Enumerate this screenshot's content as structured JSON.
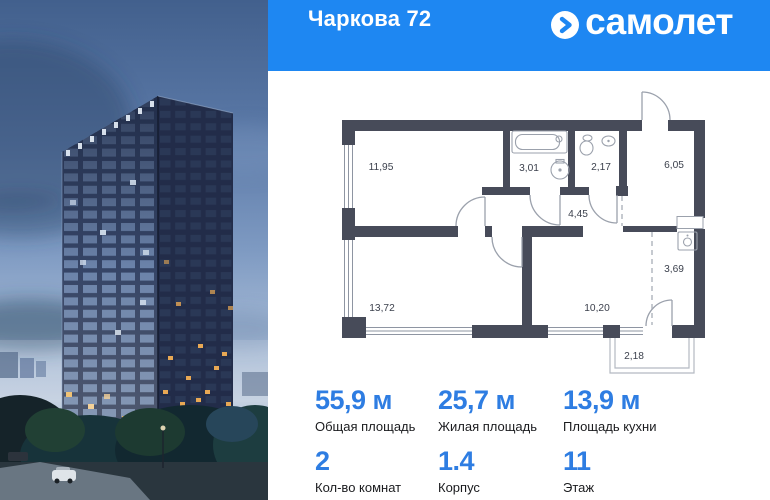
{
  "header": {
    "title": "Чаркова 72",
    "brand": {
      "icon": "samolet-arrow-circle-icon",
      "name": "самолет"
    }
  },
  "floor_plan": {
    "rooms": [
      {
        "name": "bedroom-1",
        "area": "11,95"
      },
      {
        "name": "bathroom",
        "area": "3,01"
      },
      {
        "name": "toilet",
        "area": "2,17"
      },
      {
        "name": "entrance-hall",
        "area": "6,05"
      },
      {
        "name": "corridor",
        "area": "4,45"
      },
      {
        "name": "bedroom-2",
        "area": "13,72"
      },
      {
        "name": "kitchen-living",
        "area": "10,20"
      },
      {
        "name": "kitchen-niche",
        "area": "3,69"
      },
      {
        "name": "balcony",
        "area": "2,18"
      }
    ],
    "fixtures": [
      "bathtub-icon",
      "washbasin-icon",
      "toilet-icon",
      "sink-icon",
      "kitchen-sink-icon"
    ]
  },
  "stats": {
    "primary": [
      {
        "value": "55,9 м",
        "label": "Общая площадь"
      },
      {
        "value": "25,7 м",
        "label": "Жилая площадь"
      },
      {
        "value": "13,9 м",
        "label": "Площадь кухни"
      }
    ],
    "secondary": [
      {
        "value": "2",
        "label": "Кол-во комнат"
      },
      {
        "value": "1.4",
        "label": "Корпус"
      },
      {
        "value": "11",
        "label": "Этаж"
      }
    ]
  },
  "colors": {
    "brand_blue": "#1e87f2",
    "accent_number_blue": "#2e7de2",
    "plan_wall": "#474b59",
    "header_text": "#ffffff"
  }
}
